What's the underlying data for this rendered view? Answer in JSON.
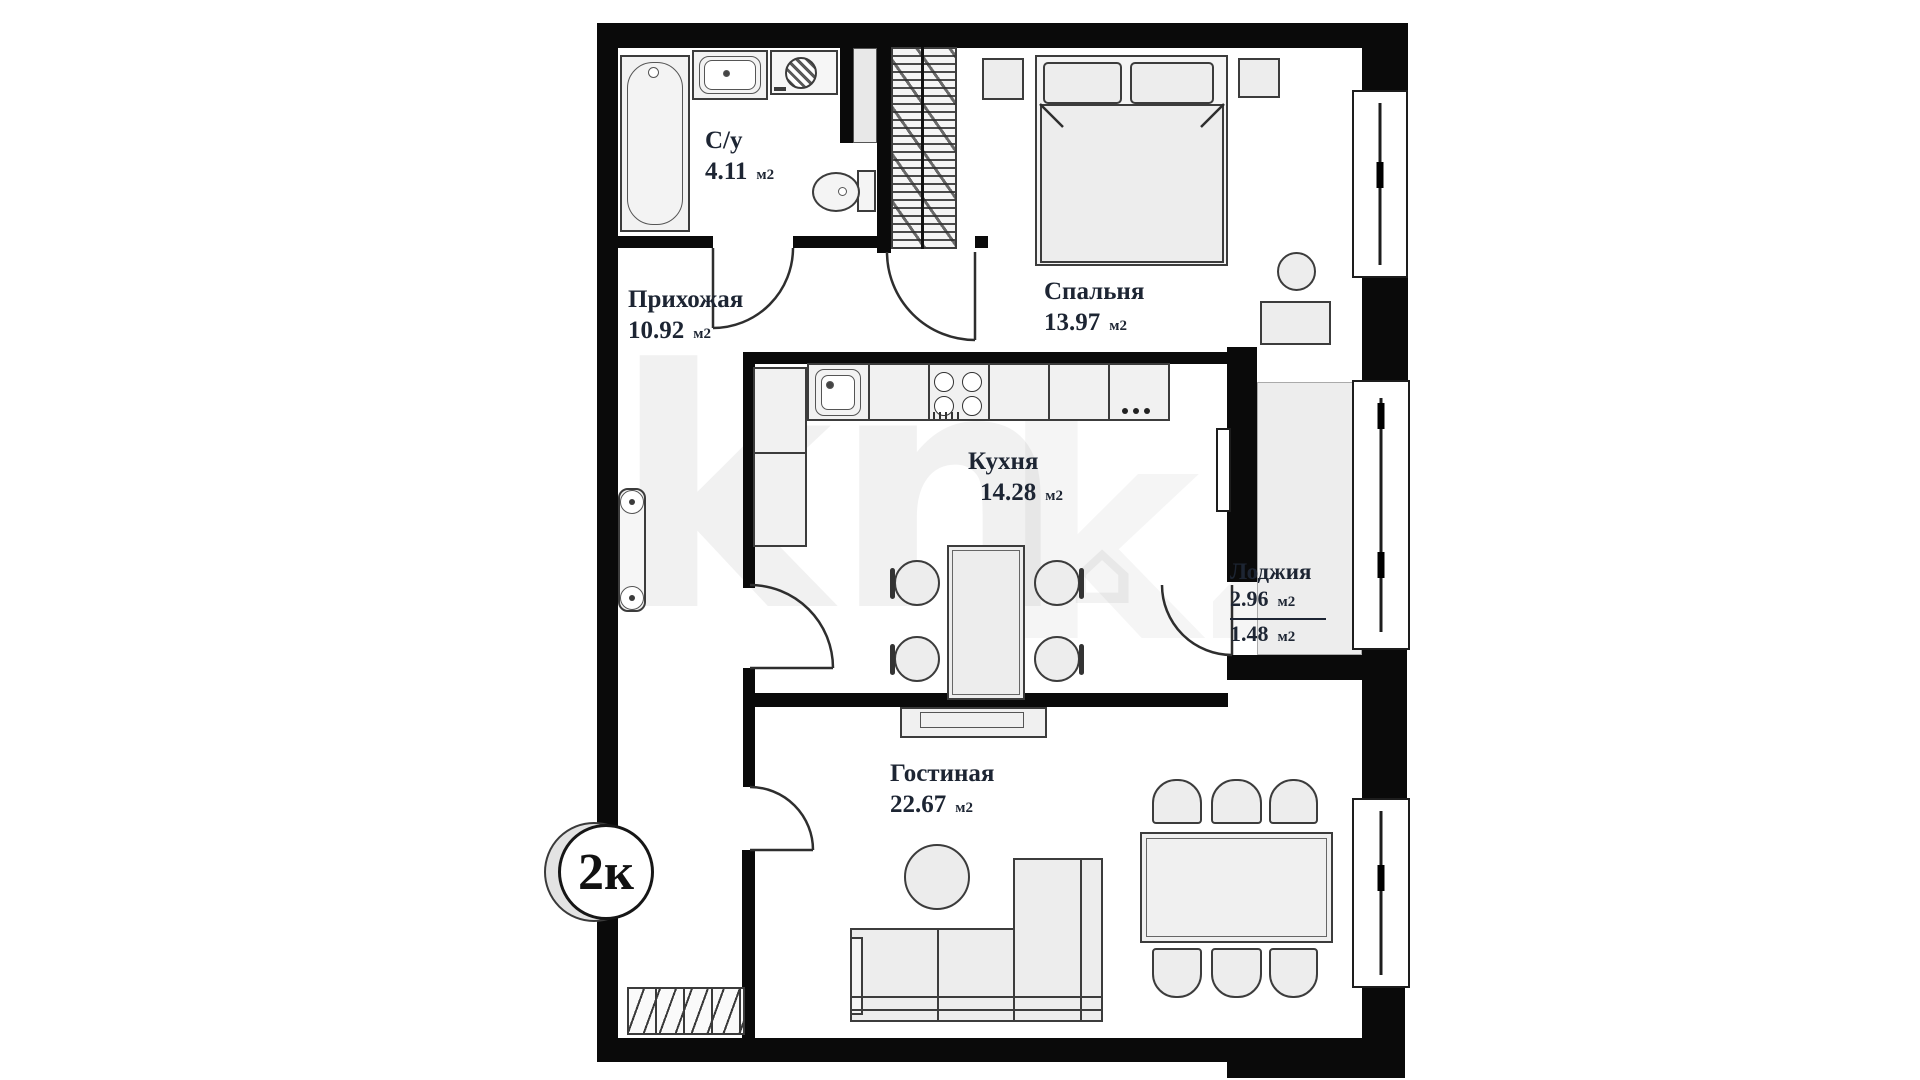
{
  "plan": {
    "badge": "2к",
    "unit": "м2",
    "watermark": {
      "left": "kn",
      "right": "kz",
      "house": "⌂"
    },
    "rooms": {
      "bathroom": {
        "name": "С/у",
        "area": "4.11"
      },
      "hallway": {
        "name": "Прихожая",
        "area": "10.92"
      },
      "bedroom": {
        "name": "Спальня",
        "area": "13.97"
      },
      "kitchen": {
        "name": "Кухня",
        "area": "14.28"
      },
      "loggia": {
        "name": "Лоджия",
        "area": "2.96",
        "area_reduced": "1.48"
      },
      "living_room": {
        "name": "Гостиная",
        "area": "22.67"
      }
    }
  }
}
